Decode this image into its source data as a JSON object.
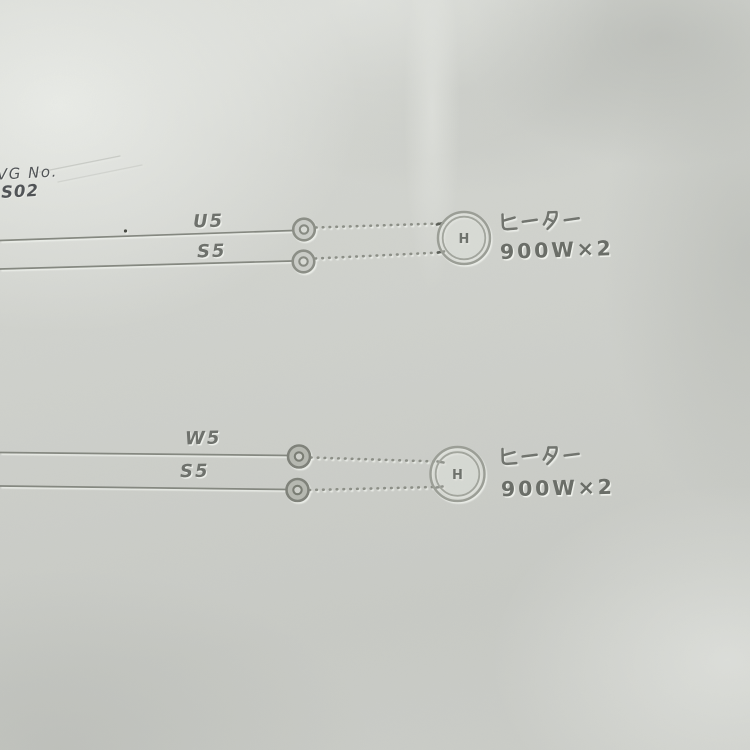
{
  "drawing": {
    "corner_label": "VG No.",
    "corner_number": "'S02"
  },
  "circuits": [
    {
      "wires": [
        {
          "label": "U5"
        },
        {
          "label": "S5"
        }
      ],
      "device": {
        "symbol": "H",
        "name": "ヒーター",
        "power": "900W×2"
      }
    },
    {
      "wires": [
        {
          "label": "W5"
        },
        {
          "label": "S5"
        }
      ],
      "device": {
        "symbol": "H",
        "name": "ヒーター",
        "power": "900W×2"
      }
    }
  ],
  "colors": {
    "paper": "#cdcfca",
    "ink": "#6c6f6a",
    "line": "#84877f",
    "corner_ink": "#4f5255"
  }
}
